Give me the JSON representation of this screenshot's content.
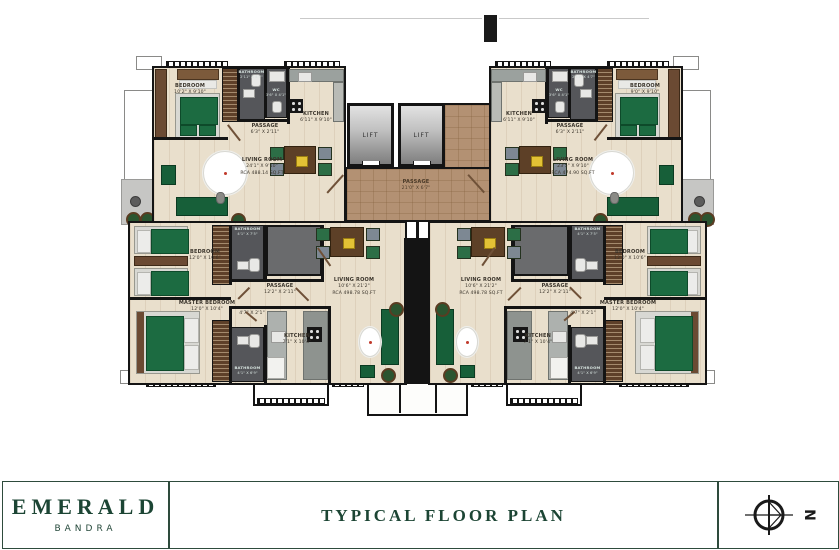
{
  "brand": {
    "name": "EMERALD",
    "location": "BANDRA",
    "plan_title": "TYPICAL FLOOR PLAN",
    "compass_direction": "N"
  },
  "core": {
    "lift_left": "LIFT",
    "lift_right": "LIFT",
    "passage": {
      "name": "PASSAGE",
      "dim": "21'0\" X 6'7\""
    }
  },
  "units": {
    "top_left": {
      "bedroom": {
        "name": "BEDROOM",
        "dim": "10'2\" X 9'10\""
      },
      "bathroom": {
        "name": "BATHROOM",
        "dim": "2'11\" X 4'7\""
      },
      "wc": {
        "name": "WC",
        "dim": "3'6\" X 4'1\""
      },
      "kitchen": {
        "name": "KITCHEN",
        "dim": "6'11\" X 9'10\""
      },
      "passage": {
        "name": "PASSAGE",
        "dim": "6'3\" X 2'11\""
      },
      "living": {
        "name": "LIVING ROOM",
        "dim": "24'1\" X 9'10\"",
        "rca": "RCA 488.14 SQ.FT"
      }
    },
    "top_right": {
      "bedroom": {
        "name": "BEDROOM",
        "dim": "9'0\" X 9'10\""
      },
      "bathroom": {
        "name": "BATHROOM",
        "dim": "2'11\" X 4'7\""
      },
      "wc": {
        "name": "WC",
        "dim": "3'6\" X 4'1\""
      },
      "kitchen": {
        "name": "KITCHEN",
        "dim": "6'11\" X 9'10\""
      },
      "passage": {
        "name": "PASSAGE",
        "dim": "6'3\" X 2'11\""
      },
      "living": {
        "name": "LIVING ROOM",
        "dim": "23'5\" X 9'10\"",
        "rca": "RCA 474.90 SQ.FT"
      }
    },
    "bottom_left": {
      "bedroom": {
        "name": "BEDROOM",
        "dim": "12'0\" X 10'6\""
      },
      "bathroom_top": {
        "name": "BATHROOM",
        "dim": "4'1\" X 7'5\""
      },
      "passage": {
        "name": "PASSAGE",
        "dim": "12'2\" X 2'11\""
      },
      "living": {
        "name": "LIVING ROOM",
        "dim": "10'6\" X 21'2\"",
        "rca": "RCA 498.78 SQ.FT"
      },
      "master_bedroom": {
        "name": "MASTER BEDROOM",
        "dim": "12'0\" X 10'4\""
      },
      "lobby_dim": "4'7\" X 2'1\"",
      "kitchen": {
        "name": "KITCHEN",
        "dim": "7'1\" X 10'4\""
      },
      "bathroom_bottom": {
        "name": "BATHROOM",
        "dim": "4'1\" X 6'9\""
      }
    },
    "bottom_right": {
      "bedroom": {
        "name": "BEDROOM",
        "dim": "12'0\" X 10'6\""
      },
      "bathroom_top": {
        "name": "BATHROOM",
        "dim": "4'1\" X 7'5\""
      },
      "passage": {
        "name": "PASSAGE",
        "dim": "12'2\" X 2'11\""
      },
      "living": {
        "name": "LIVING ROOM",
        "dim": "10'6\" X 21'2\"",
        "rca": "RCA 498.78 SQ.FT"
      },
      "master_bedroom": {
        "name": "MASTER BEDROOM",
        "dim": "12'0\" X 10'4\""
      },
      "lobby_dim": "4'7\" X 2'1\"",
      "kitchen": {
        "name": "KITCHEN",
        "dim": "7'1\" X 10'4\""
      },
      "bathroom_bottom": {
        "name": "BATHROOM",
        "dim": "4'1\" X 6'9\""
      }
    }
  },
  "colors": {
    "brand_green": "#1c4534",
    "wall_black": "#141414",
    "floor_beige": "#e9dfcc",
    "passage_brown": "#b39173",
    "furniture_green": "#175f39",
    "tile_gray": "#55565a"
  }
}
